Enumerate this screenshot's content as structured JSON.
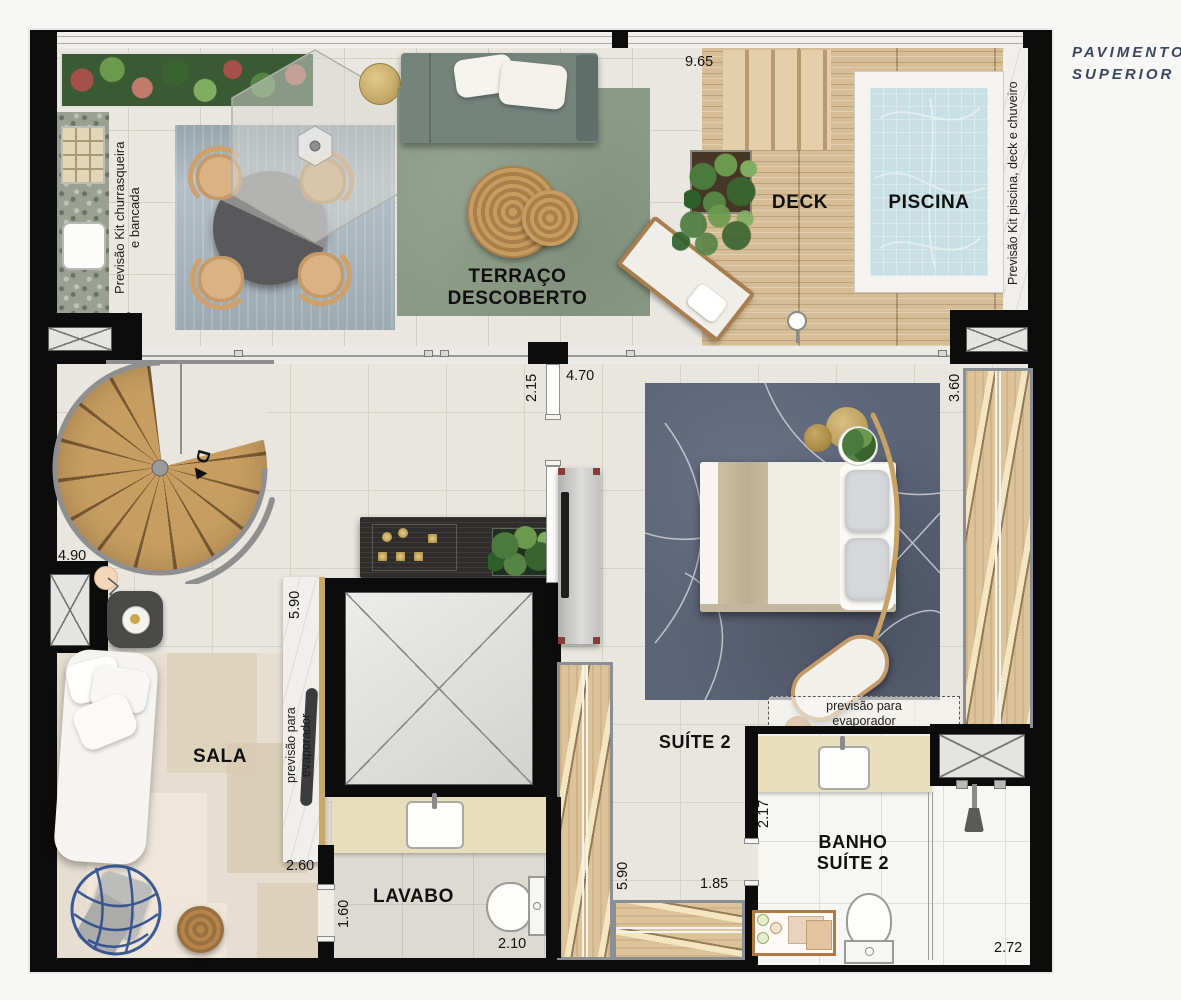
{
  "title": {
    "line1": "PAVIMENTO",
    "line2": "SUPERIOR"
  },
  "rooms": {
    "terraco_line1": "TERRAÇO",
    "terraco_line2": "DESCOBERTO",
    "deck": "DECK",
    "piscina": "PISCINA",
    "sala": "SALA",
    "lavabo": "LAVABO",
    "suite": "SUÍTE 2",
    "banho_line1": "BANHO",
    "banho_line2": "SUÍTE 2"
  },
  "notes": {
    "bbq_line1": "Previsão Kit churrasqueira",
    "bbq_line2": "e bancada",
    "pool": "Previsão Kit piscina, deck e chuveiro",
    "evap_sala_line1": "previsão para",
    "evap_sala_line2": "evaporador",
    "evap_suite_line1": "previsão para",
    "evap_suite_line2": "evaporador"
  },
  "stair": {
    "direction": "D"
  },
  "dims": {
    "terrace_width": "9.65",
    "bbq": "2.95",
    "hall": "2.15",
    "suite_top": "4.70",
    "closet": "3.60",
    "stair": "4.90",
    "counter": "5.90",
    "sala": "2.60",
    "lavabo_door": "1.60",
    "lavabo_width": "2.10",
    "suite_side": "5.90",
    "corridor": "1.85",
    "banho_side": "2.17",
    "banho_width": "2.72"
  },
  "colors": {
    "wall": "#0c0c0c",
    "deck_wood": "#d6bd95",
    "pool_water": "#c8dfe3",
    "terrace_rug_green": "#8b9a85",
    "terrace_rug_blue": "#b3bfc6",
    "suite_rug": "#5c6478",
    "title": "#3a4660"
  }
}
